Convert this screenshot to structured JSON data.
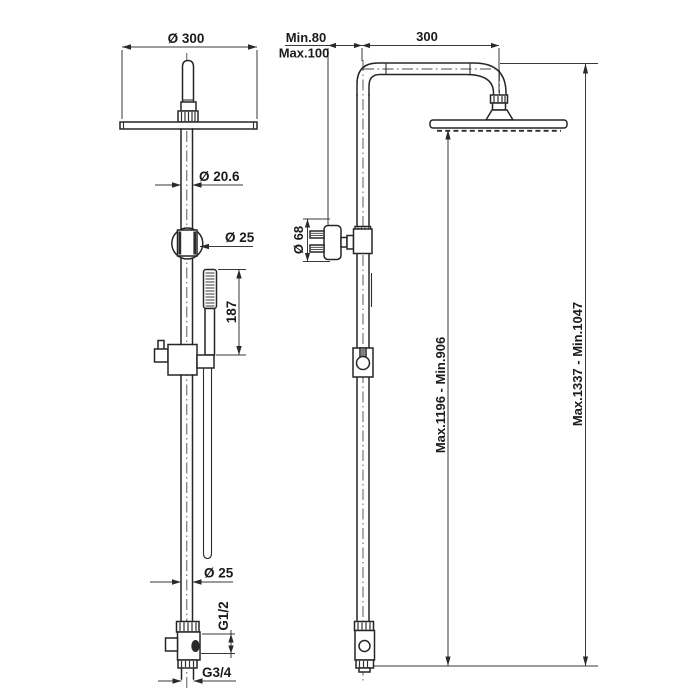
{
  "drawing": {
    "front_view": {
      "dim_head_diameter": "Ø 300",
      "dim_riser_diameter": "Ø 20.6",
      "dim_diverter_diameter": "Ø 25",
      "dim_handshower_length": "187",
      "dim_lower_riser_diameter": "Ø 25",
      "dim_inlet_thread": "G1/2",
      "dim_outlet_thread": "G3/4"
    },
    "side_view": {
      "dim_wall_offset_min": "Min.80",
      "dim_wall_offset_max": "Max.100",
      "dim_arm_reach": "300",
      "dim_handshower_head_diameter": "Ø 68",
      "dim_height_to_head": "Max.1196 - Min.906",
      "dim_overall_height": "Max.1337 - Min.1047"
    }
  }
}
